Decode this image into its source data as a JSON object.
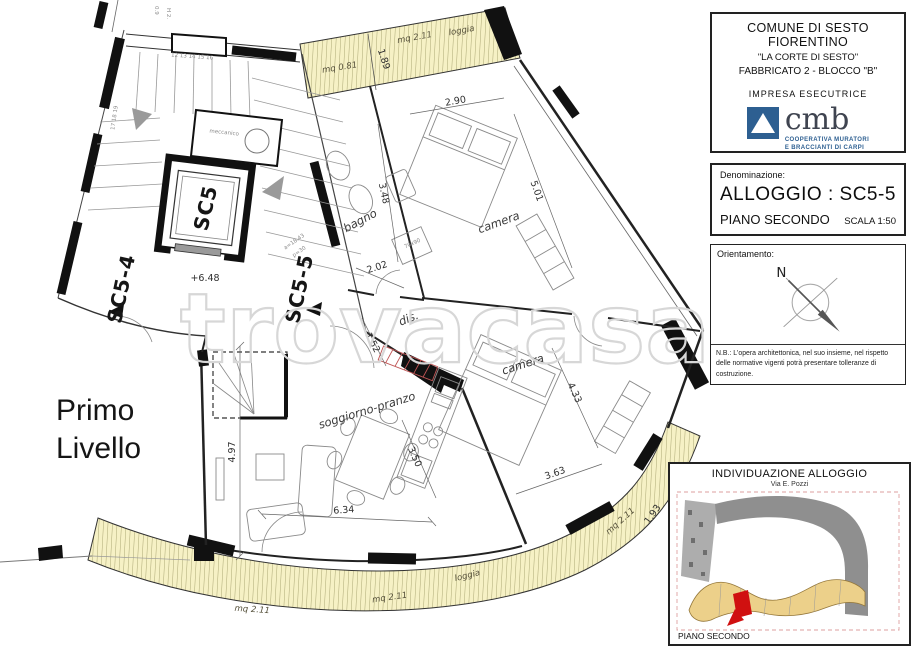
{
  "colors": {
    "loggia_fill": "#f6f1c5",
    "hatch_line": "#98935f",
    "wall": "#111111",
    "cmb_blue": "#2d5f91",
    "highlight_red": "#d01010",
    "road_gray": "#8f8f8f",
    "building_tan": "#ecd08a",
    "watermark_gray": "#d7d7d7"
  },
  "title_block": {
    "municipality": "COMUNE DI SESTO FIORENTINO",
    "project": "\"LA CORTE DI SESTO\"",
    "building": "FABBRICATO 2 - BLOCCO \"B\"",
    "contractor_label": "IMPRESA ESECUTRICE",
    "logo_text": "cmb",
    "logo_sub1": "COOPERATIVA MURATORI",
    "logo_sub2": "E BRACCIANTI DI CARPI"
  },
  "denominazione": {
    "label": "Denominazione:",
    "apartment": "ALLOGGIO : SC5-5",
    "floor": "PIANO SECONDO",
    "scale": "SCALA 1:50"
  },
  "orientamento": {
    "label": "Orientamento:",
    "north": "N",
    "note": "N.B.: L'opera architettonica, nel suo insieme, nel rispetto delle normative vigenti potrà presentare tolleranze di costruzione."
  },
  "individuazione": {
    "title": "INDIVIDUAZIONE ALLOGGIO",
    "street": "Via E. Pozzi",
    "floor": "PIANO SECONDO"
  },
  "plan": {
    "level_line1": "Primo",
    "level_line2": "Livello",
    "watermark": "trovacasa",
    "core": {
      "elevator": "SC5",
      "stair_left": "SC5-4",
      "stair_right": "SC5-5",
      "landing_level": "+6.48",
      "mech_room": "meccanico",
      "stair_note_a": "a=18.43",
      "stair_note_p": "p=30",
      "steps_top": "12  13  14  15  16",
      "steps_left": "17  18  19"
    },
    "rooms": {
      "bagno": "bagno",
      "camera_top": "camera",
      "camera_bottom": "camera",
      "living": "soggiorno-pranzo",
      "hall": "dis."
    },
    "dims": {
      "d1": "2.90",
      "d2": "5.01",
      "d3": "3.48",
      "d4": "2.02",
      "d5": "1.52",
      "d6": "4.33",
      "d7": "3.63",
      "d8": "3.50",
      "d9": "6.34",
      "d10": "4.97",
      "d11": "1.89",
      "d12": "1.93",
      "shower": "70x90",
      "win1": "0.9",
      "win2": "H 2."
    },
    "loggias": {
      "top_small": "mq 0.81",
      "top_mq": "mq 2.11",
      "top_label": "loggia",
      "bottom_left": "mq 2.11",
      "bottom_center": "mq 2.11",
      "bottom_label": "loggia",
      "bottom_right": "mq 2.11"
    }
  }
}
